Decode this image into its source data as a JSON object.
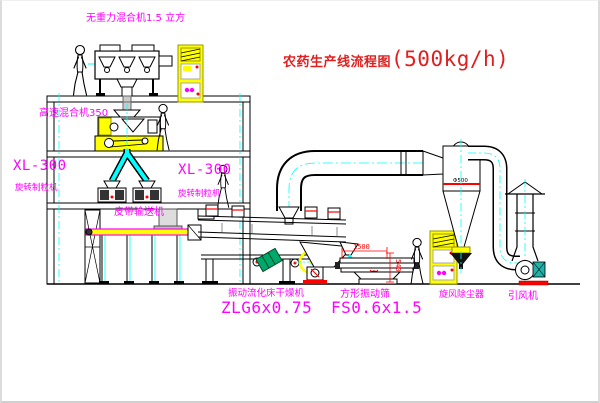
{
  "title": {
    "cn": "农药生产线流程图",
    "capacity": "(500kg/h)"
  },
  "equipment": {
    "gravity_mixer_label": "无重力混合机1.5 立方",
    "high_speed_mixer_label": "高速混合机350",
    "granulator_left": {
      "model": "XL-300",
      "name": "旋转制粒机"
    },
    "granulator_center": {
      "model": "XL-300",
      "name": "旋转制粒机"
    },
    "belt_conveyor_label": "皮带输送机",
    "dryer": {
      "name": "振动流化床干燥机",
      "model": "ZLG6x0.75"
    },
    "screen": {
      "name": "方形振动筛",
      "model": "FS0.6x1.5",
      "dim_length": "1500",
      "dim_height": "540"
    },
    "cyclone": {
      "name": "旋风除尘器",
      "spec": "Φ500"
    },
    "fan_label": "引风机"
  },
  "colors": {
    "label_magenta": "#ff00ff",
    "title_red": "#e02020",
    "equipment_yellow": "#ffff00",
    "pipe_cyan": "#00ffff",
    "dimension_red": "#ff0000",
    "motor_teal": "#20b2aa"
  }
}
